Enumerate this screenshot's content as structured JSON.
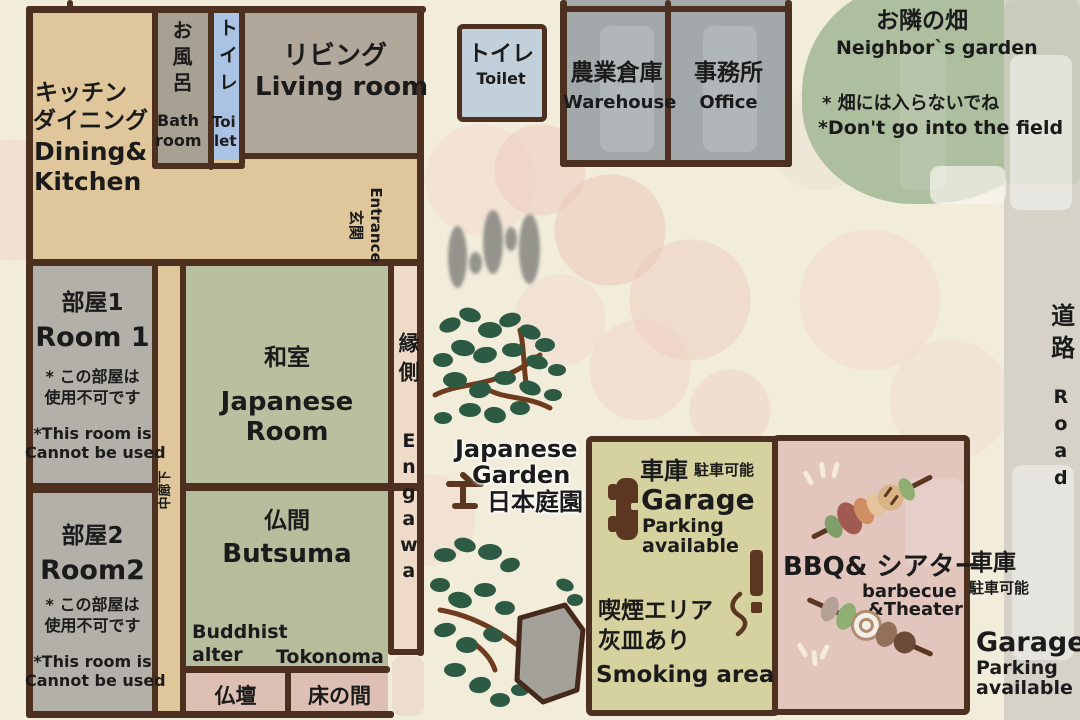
{
  "house": {
    "kitchen": {
      "jp1": "キッチン",
      "jp2": "ダイニング",
      "en1": "Dining&",
      "en2": "Kitchen"
    },
    "bath": {
      "jp": "お風呂",
      "en1": "Bath",
      "en2": "room"
    },
    "toilet": {
      "jp": "トイレ",
      "en1": "Toi",
      "en2": "let"
    },
    "living": {
      "jp": "リビング",
      "en": "Living room"
    },
    "entrance": {
      "jp": "玄関",
      "en": "Entrance"
    },
    "corridor": {
      "jp": "中廊下"
    },
    "room1": {
      "jp": "部屋1",
      "en": "Room 1",
      "note_jp1": "* この部屋は",
      "note_jp2": "使用不可です",
      "note_en1": "*This room is",
      "note_en2": "Cannot be used"
    },
    "room2": {
      "jp": "部屋2",
      "en": "Room2",
      "note_jp1": "* この部屋は",
      "note_jp2": "使用不可です",
      "note_en1": "*This room is",
      "note_en2": "Cannot be used"
    },
    "japanese_room": {
      "jp": "和室",
      "en1": "Japanese",
      "en2": "Room"
    },
    "butsuma": {
      "jp": "仏間",
      "en": "Butsuma",
      "alter_en1": "Buddhist",
      "alter_en2": "alter",
      "tokonoma_en": "Tokonoma"
    },
    "butsudan": {
      "jp": "仏壇"
    },
    "tokonoma": {
      "jp": "床の間"
    },
    "engawa": {
      "jp": "縁側",
      "en": "Engawa"
    }
  },
  "grounds": {
    "outside_toilet": {
      "jp": "トイレ",
      "en": "Toilet"
    },
    "warehouse": {
      "jp": "農業倉庫",
      "en": "Warehouse"
    },
    "office": {
      "jp": "事務所",
      "en": "Office"
    },
    "neighbor_garden": {
      "jp": "お隣の畑",
      "en": "Neighbor`s garden",
      "warn_jp": "* 畑には入らないでね",
      "warn_en": "*Don't go into the field"
    },
    "japanese_garden": {
      "en1": "Japanese",
      "en2": "Garden",
      "jp": "日本庭園"
    },
    "garage1": {
      "jp": "車庫",
      "jp_note": "駐車可能",
      "en": "Garage",
      "en_note1": "Parking",
      "en_note2": "available"
    },
    "smoking": {
      "jp1": "喫煙エリア",
      "jp2": "灰皿あり",
      "en": "Smoking area"
    },
    "bbq": {
      "title": "BBQ& シアター",
      "en1": "barbecue",
      "en2": "&Theater"
    },
    "garage2": {
      "jp": "車庫",
      "jp_note": "駐車可能",
      "en": "Garage",
      "en_note1": "Parking",
      "en_note2": "available"
    },
    "road": {
      "jp": "道路",
      "en": "Road"
    }
  },
  "colors": {
    "wall_brown": "#4e3020",
    "tan_floor": "#dfc69b",
    "tatami_green": "#b8c0a0",
    "toilet_blue": "#aac2e4",
    "gray_room": "#b3afa9",
    "pink_room": "#ddbfb3",
    "engawa_pink": "#eedac6",
    "building_gray": "#a3a8ab",
    "garage_olive": "#d6d2a0",
    "bbq_pink": "#e2c5bd",
    "garden_green": "#aebf9f",
    "road_gray": "#d6d2c8",
    "background_cream": "#f2ecdb"
  }
}
